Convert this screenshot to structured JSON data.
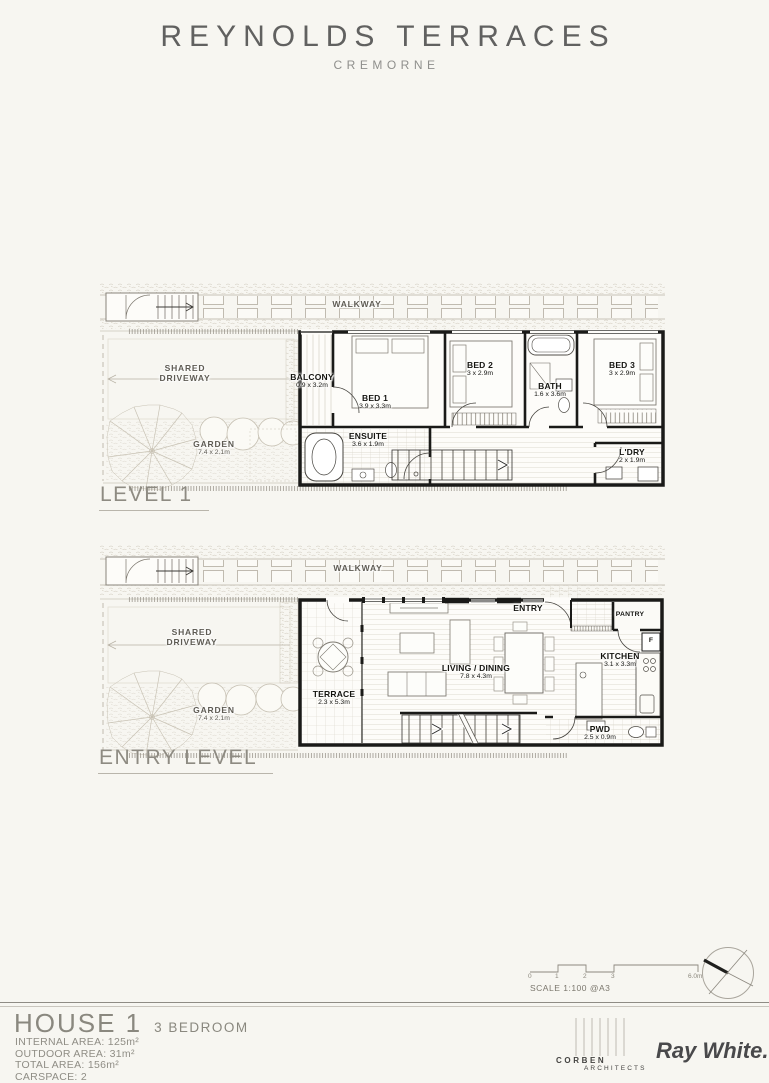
{
  "header": {
    "title": "REYNOLDS TERRACES",
    "subtitle": "CREMORNE"
  },
  "levels": [
    {
      "name": "LEVEL 1",
      "site": {
        "walkway": "WALKWAY",
        "driveway": "SHARED DRIVEWAY",
        "garden": "GARDEN",
        "garden_dims": "7.4 x 2.1m"
      },
      "rooms": [
        {
          "name": "BALCONY",
          "dims": "0.9 x 3.2m"
        },
        {
          "name": "BED 1",
          "dims": "3.9 x 3.3m"
        },
        {
          "name": "BED 2",
          "dims": "3 x 2.9m"
        },
        {
          "name": "BATH",
          "dims": "1.6 x 3.6m"
        },
        {
          "name": "BED 3",
          "dims": "3 x 2.9m"
        },
        {
          "name": "ENSUITE",
          "dims": "3.6 x 1.9m"
        },
        {
          "name": "L'DRY",
          "dims": "2 x 1.9m"
        }
      ]
    },
    {
      "name": "ENTRY LEVEL",
      "site": {
        "walkway": "WALKWAY",
        "driveway": "SHARED DRIVEWAY",
        "garden": "GARDEN",
        "garden_dims": "7.4 x 2.1m"
      },
      "rooms": [
        {
          "name": "TERRACE",
          "dims": "2.3 x 5.3m"
        },
        {
          "name": "LIVING / DINING",
          "dims": "7.8 x 4.3m"
        },
        {
          "name": "ENTRY"
        },
        {
          "name": "PANTRY"
        },
        {
          "name": "F"
        },
        {
          "name": "KITCHEN",
          "dims": "3.1 x 3.3m"
        },
        {
          "name": "PWD",
          "dims": "2.5 x 0.9m"
        }
      ]
    }
  ],
  "scale_bar": {
    "ticks": [
      "0",
      "1",
      "2",
      "3",
      "6.0m"
    ],
    "label": "SCALE 1:100 @A3"
  },
  "footer": {
    "house": "HOUSE 1",
    "type": "3 BEDROOM",
    "specs": [
      "INTERNAL AREA: 125m²",
      "OUTDOOR AREA: 31m²",
      "TOTAL AREA: 156m²",
      "CARSPACE: 2"
    ],
    "architect_line1": "CORBEN",
    "architect_line2": "ARCHITECTS",
    "agency": "Ray White."
  }
}
